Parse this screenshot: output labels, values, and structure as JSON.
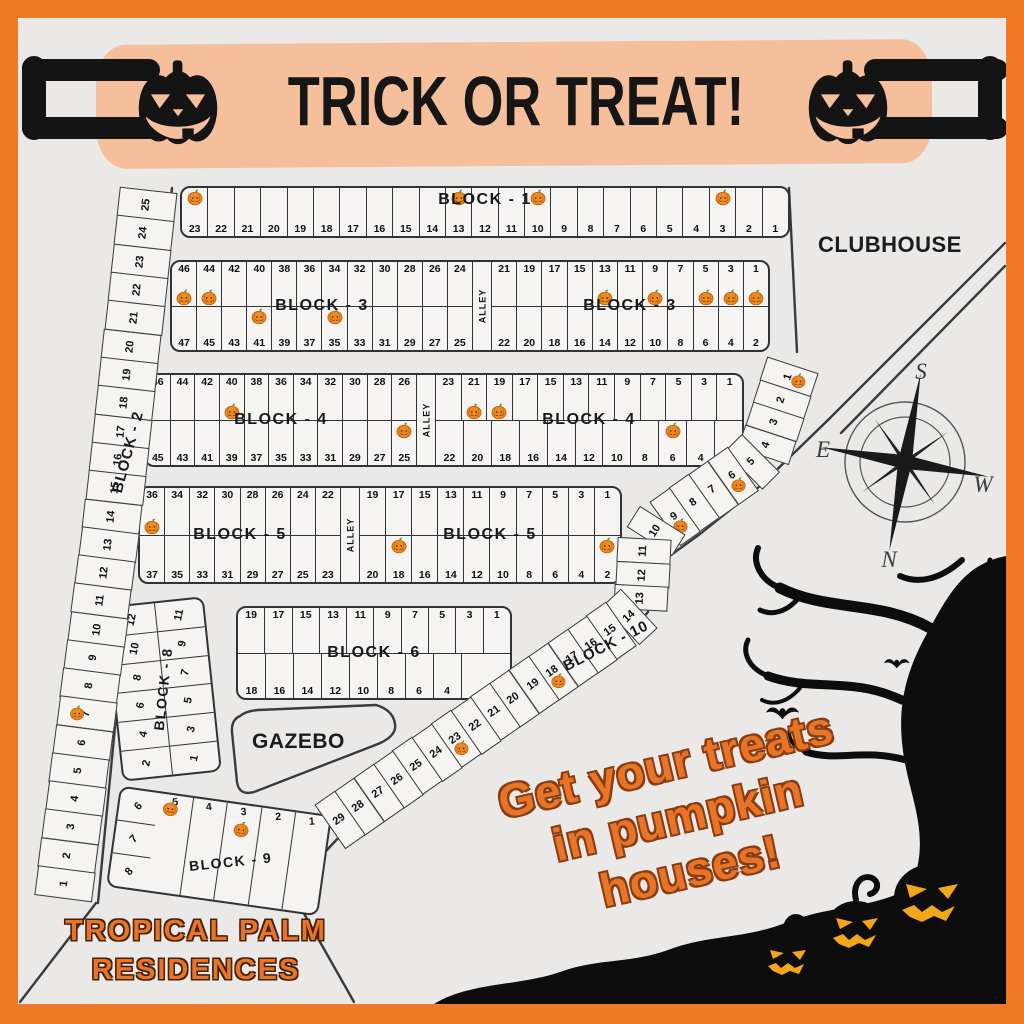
{
  "banner": {
    "title": "TRICK OR TREAT!"
  },
  "labels": {
    "clubhouse": "CLUBHOUSE",
    "gazebo": "GAZEBO",
    "alley": "ALLEY"
  },
  "compass": {
    "top": "S",
    "left": "E",
    "right": "W",
    "bottom": "N"
  },
  "tagline": {
    "lines": [
      "Get your treats",
      "in pumpkin",
      "houses!"
    ]
  },
  "footer": {
    "lines": [
      "TROPICAL PALM",
      "RESIDENCES"
    ]
  },
  "colors": {
    "frame": "#EE7A28",
    "banner_band": "#F5BF9B",
    "map_bg": "#EAE9E7",
    "lot_bg": "#F5F4F2",
    "line": "#333333",
    "accent_text": "#E87428",
    "pumpkin_body": "#EE8A1F",
    "jack_face": "#F2A71B"
  },
  "blocks": {
    "block1": {
      "label": "BLOCK - 1",
      "cells": [
        23,
        22,
        21,
        20,
        19,
        18,
        17,
        16,
        15,
        14,
        13,
        12,
        11,
        10,
        9,
        8,
        7,
        6,
        5,
        4,
        3,
        2,
        1
      ],
      "pumpkins": [
        23,
        13,
        10,
        3
      ]
    },
    "block2": {
      "label": "BLOCK - 2",
      "cells": [
        25,
        24,
        23,
        22,
        21,
        20,
        19,
        18,
        17,
        16,
        15,
        14,
        13,
        12,
        11,
        10,
        9,
        8,
        7,
        6,
        5,
        4,
        3,
        2,
        1
      ],
      "pumpkins": [
        7
      ]
    },
    "block3": {
      "label": "BLOCK - 3",
      "left_top": [
        46,
        44,
        42,
        40,
        38,
        36,
        34,
        32,
        30,
        28,
        26,
        24
      ],
      "left_bottom": [
        47,
        45,
        43,
        41,
        39,
        37,
        35,
        33,
        31,
        29,
        27,
        25
      ],
      "right_top": [
        21,
        19,
        17,
        15,
        13,
        11,
        9,
        7,
        5,
        3,
        1
      ],
      "right_bottom": [
        22,
        20,
        18,
        16,
        14,
        12,
        10,
        8,
        6,
        4,
        2
      ],
      "pumpkins_left_top": [
        46,
        44
      ],
      "pumpkins_left_bottom": [
        41,
        35
      ],
      "pumpkins_right_top": [
        13,
        9,
        5,
        3,
        1
      ],
      "pumpkins_right_bottom": []
    },
    "block4": {
      "label": "BLOCK - 4",
      "left_top": [
        46,
        44,
        42,
        40,
        38,
        36,
        34,
        32,
        30,
        28,
        26
      ],
      "left_bottom": [
        45,
        43,
        41,
        39,
        37,
        35,
        33,
        31,
        29,
        27,
        25
      ],
      "right_top": [
        23,
        21,
        19,
        17,
        15,
        13,
        11,
        9,
        7,
        5,
        3,
        1
      ],
      "right_bottom": [
        22,
        20,
        18,
        16,
        14,
        12,
        10,
        8,
        6,
        4,
        2
      ],
      "pumpkins_left_top": [
        40
      ],
      "pumpkins_left_bottom": [
        25
      ],
      "pumpkins_right_top": [
        21,
        19
      ],
      "pumpkins_right_bottom": [
        6
      ]
    },
    "block5": {
      "label": "BLOCK - 5",
      "left_top": [
        36,
        34,
        32,
        30,
        28,
        26,
        24,
        22
      ],
      "left_bottom": [
        37,
        35,
        33,
        31,
        29,
        27,
        25,
        23
      ],
      "right_top": [
        19,
        17,
        15,
        13,
        11,
        9,
        7,
        5,
        3,
        1
      ],
      "right_bottom": [
        20,
        18,
        16,
        14,
        12,
        10,
        8,
        6,
        4,
        2
      ],
      "pumpkins_left_top": [
        36
      ],
      "pumpkins_left_bottom": [],
      "pumpkins_right_top": [],
      "pumpkins_right_bottom": [
        18,
        2
      ]
    },
    "block6": {
      "label": "BLOCK - 6",
      "top": [
        19,
        17,
        15,
        13,
        11,
        9,
        7,
        5,
        3,
        1
      ],
      "bottom": [
        18,
        16,
        14,
        12,
        10,
        8,
        6,
        4,
        2
      ],
      "pumpkins_top": [],
      "pumpkins_bottom": []
    },
    "block8": {
      "label": "BLOCK - 8",
      "col_left": [
        12,
        10,
        8,
        6,
        4,
        2
      ],
      "col_right": [
        11,
        9,
        7,
        5,
        3,
        1
      ],
      "pumpkins": []
    },
    "block9": {
      "label": "BLOCK - 9",
      "side": [
        6,
        7,
        8
      ],
      "row": [
        5,
        4,
        3,
        2,
        1
      ],
      "pumpkins": [
        6,
        3
      ]
    },
    "block10": {
      "label": "BLOCK - 10",
      "cells": [
        1,
        2,
        3,
        4,
        5,
        6,
        7,
        8,
        9,
        10,
        11,
        12,
        13,
        14,
        15,
        16,
        17,
        18,
        19,
        20,
        21,
        22,
        23,
        24,
        25,
        26,
        27,
        28,
        29
      ],
      "pumpkins": [
        1,
        6,
        9,
        18,
        23
      ]
    }
  }
}
